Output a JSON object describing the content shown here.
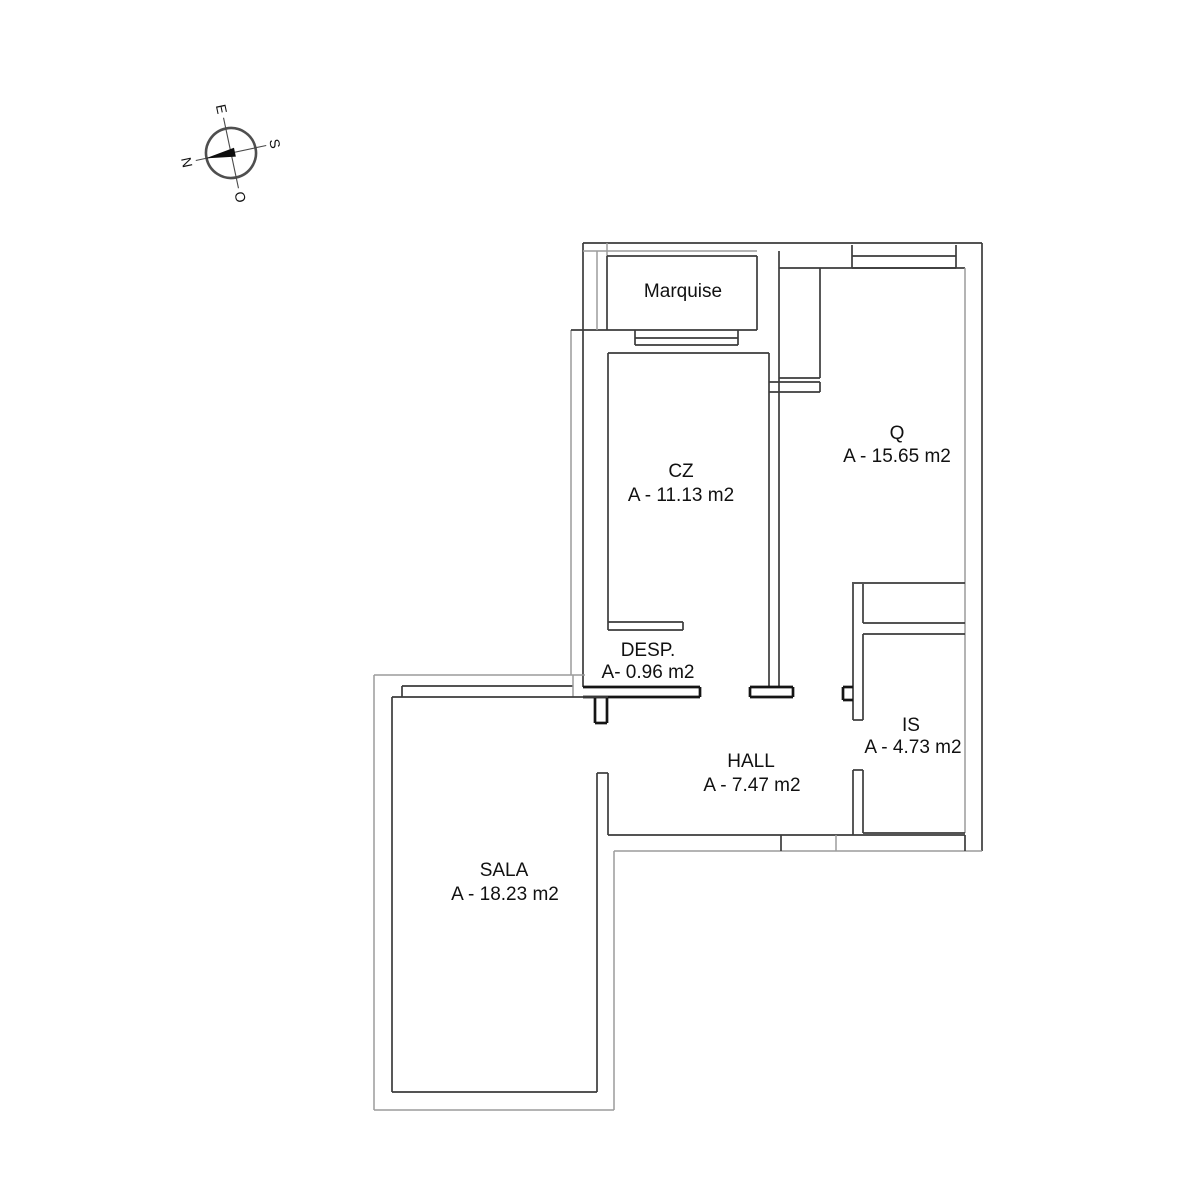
{
  "compass": {
    "north": "N",
    "east": "E",
    "south": "S",
    "west": "O"
  },
  "rooms": [
    {
      "id": "marquise",
      "name": "Marquise",
      "area": ""
    },
    {
      "id": "cz",
      "name": "CZ",
      "area": "A - 11.13 m2"
    },
    {
      "id": "q",
      "name": "Q",
      "area": "A - 15.65 m2"
    },
    {
      "id": "desp",
      "name": "DESP.",
      "area": "A- 0.96 m2"
    },
    {
      "id": "is",
      "name": "IS",
      "area": "A - 4.73 m2"
    },
    {
      "id": "hall",
      "name": "HALL",
      "area": "A - 7.47 m2"
    },
    {
      "id": "sala",
      "name": "SALA",
      "area": "A - 18.23 m2"
    }
  ]
}
